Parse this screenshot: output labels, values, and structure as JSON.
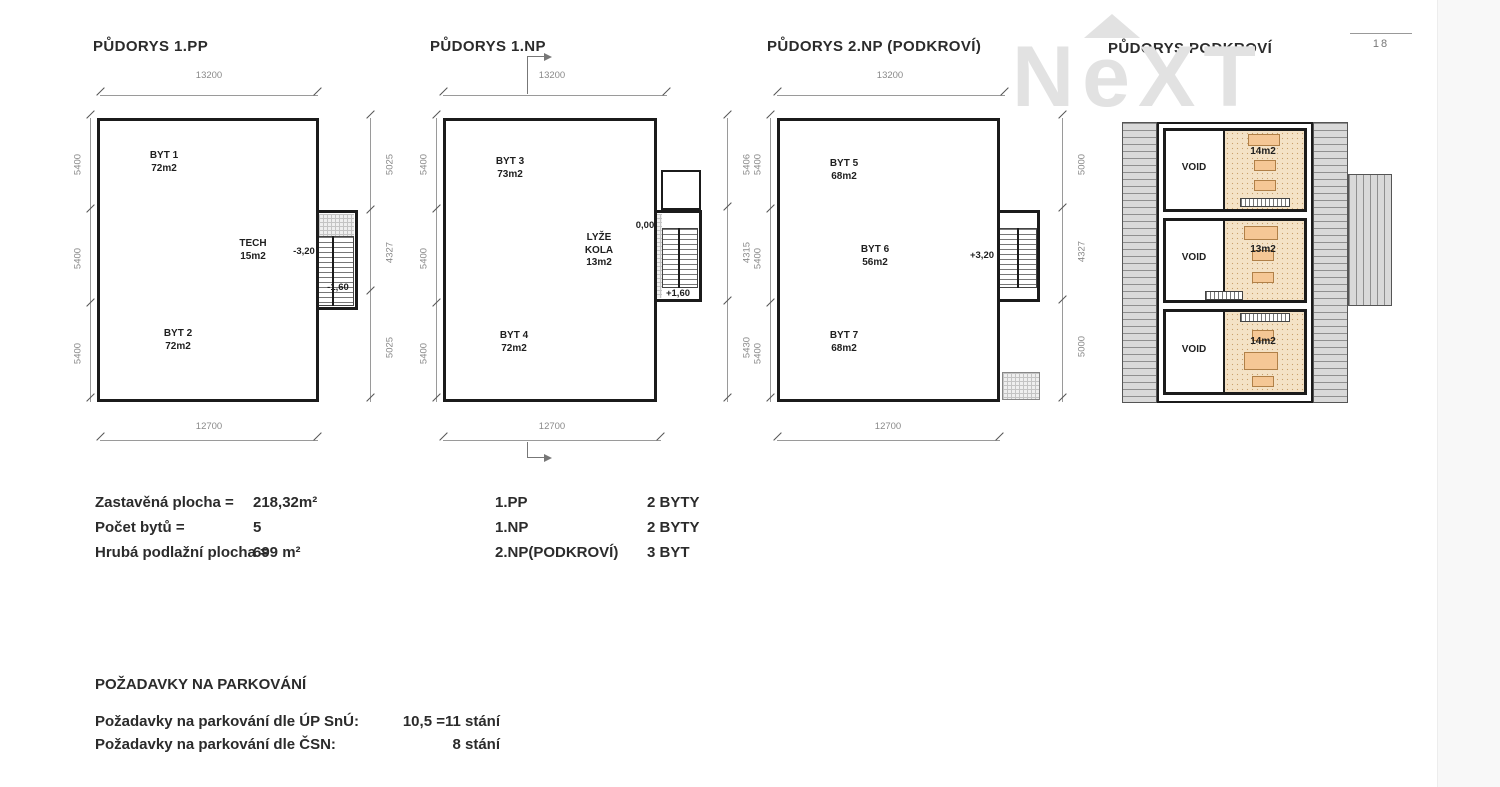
{
  "page": {
    "number": "18"
  },
  "watermark": {
    "letters": [
      "N",
      "e",
      "X",
      "T"
    ]
  },
  "plans": [
    {
      "title": "PŮDORYS 1.PP",
      "dim_top": "13200",
      "dim_bottom": "12700",
      "dims_left": [
        "5400",
        "5400",
        "5400"
      ],
      "dims_right": [
        "5025",
        "4327",
        "5025"
      ],
      "apartments": [
        {
          "name": "BYT 1",
          "area": "72m2"
        },
        {
          "name": "BYT 2",
          "area": "72m2"
        }
      ],
      "tech": {
        "name": "TECH",
        "area": "15m2"
      },
      "levels": {
        "main": "-3,20",
        "landing": "-1,60"
      }
    },
    {
      "title": "PŮDORYS 1.NP",
      "dim_top": "13200",
      "dim_bottom": "12700",
      "dims_left": [
        "5400",
        "5400",
        "5400"
      ],
      "dims_right": [
        "5406",
        "4315",
        "5430"
      ],
      "apartments": [
        {
          "name": "BYT 3",
          "area": "73m2"
        },
        {
          "name": "BYT 4",
          "area": "72m2"
        }
      ],
      "store": {
        "l1": "LYŽE",
        "l2": "KOLA",
        "l3": "13m2"
      },
      "levels": {
        "main": "0,00",
        "landing": "+1,60"
      }
    },
    {
      "title": "PŮDORYS 2.NP (PODKROVÍ)",
      "dim_top": "13200",
      "dim_bottom": "12700",
      "dims_left": [
        "5400",
        "5400",
        "5400"
      ],
      "dims_right": [
        "5000",
        "4327",
        "5000"
      ],
      "apartments": [
        {
          "name": "BYT 5",
          "area": "68m2"
        },
        {
          "name": "BYT 6",
          "area": "56m2"
        },
        {
          "name": "BYT 7",
          "area": "68m2"
        }
      ],
      "levels": {
        "main": "+3,20"
      }
    },
    {
      "title": "PŮDORYS PODKROVÍ",
      "voids": [
        "VOID",
        "VOID",
        "VOID"
      ],
      "areas": [
        "14m2",
        "13m2",
        "14m2"
      ]
    }
  ],
  "summary": {
    "rows": [
      {
        "label": "Zastavěná plocha =",
        "value": "218,32m²"
      },
      {
        "label": "Počet bytů =",
        "value": "5"
      },
      {
        "label": "Hrubá podlažní plocha =",
        "value": "699 m²"
      }
    ],
    "floors": [
      {
        "label": "1.PP",
        "value": "2 BYTY"
      },
      {
        "label": "1.NP",
        "value": "2 BYTY"
      },
      {
        "label": "2.NP(PODKROVÍ)",
        "value": "3 BYT"
      }
    ]
  },
  "parking": {
    "heading": "POŽADAVKY NA PARKOVÁNÍ",
    "rows": [
      {
        "label": "Požadavky na parkování dle ÚP SnÚ:",
        "value": "10,5 =11 stání"
      },
      {
        "label": "Požadavky na parkování dle ČSN:",
        "value": "8 stání"
      }
    ]
  }
}
